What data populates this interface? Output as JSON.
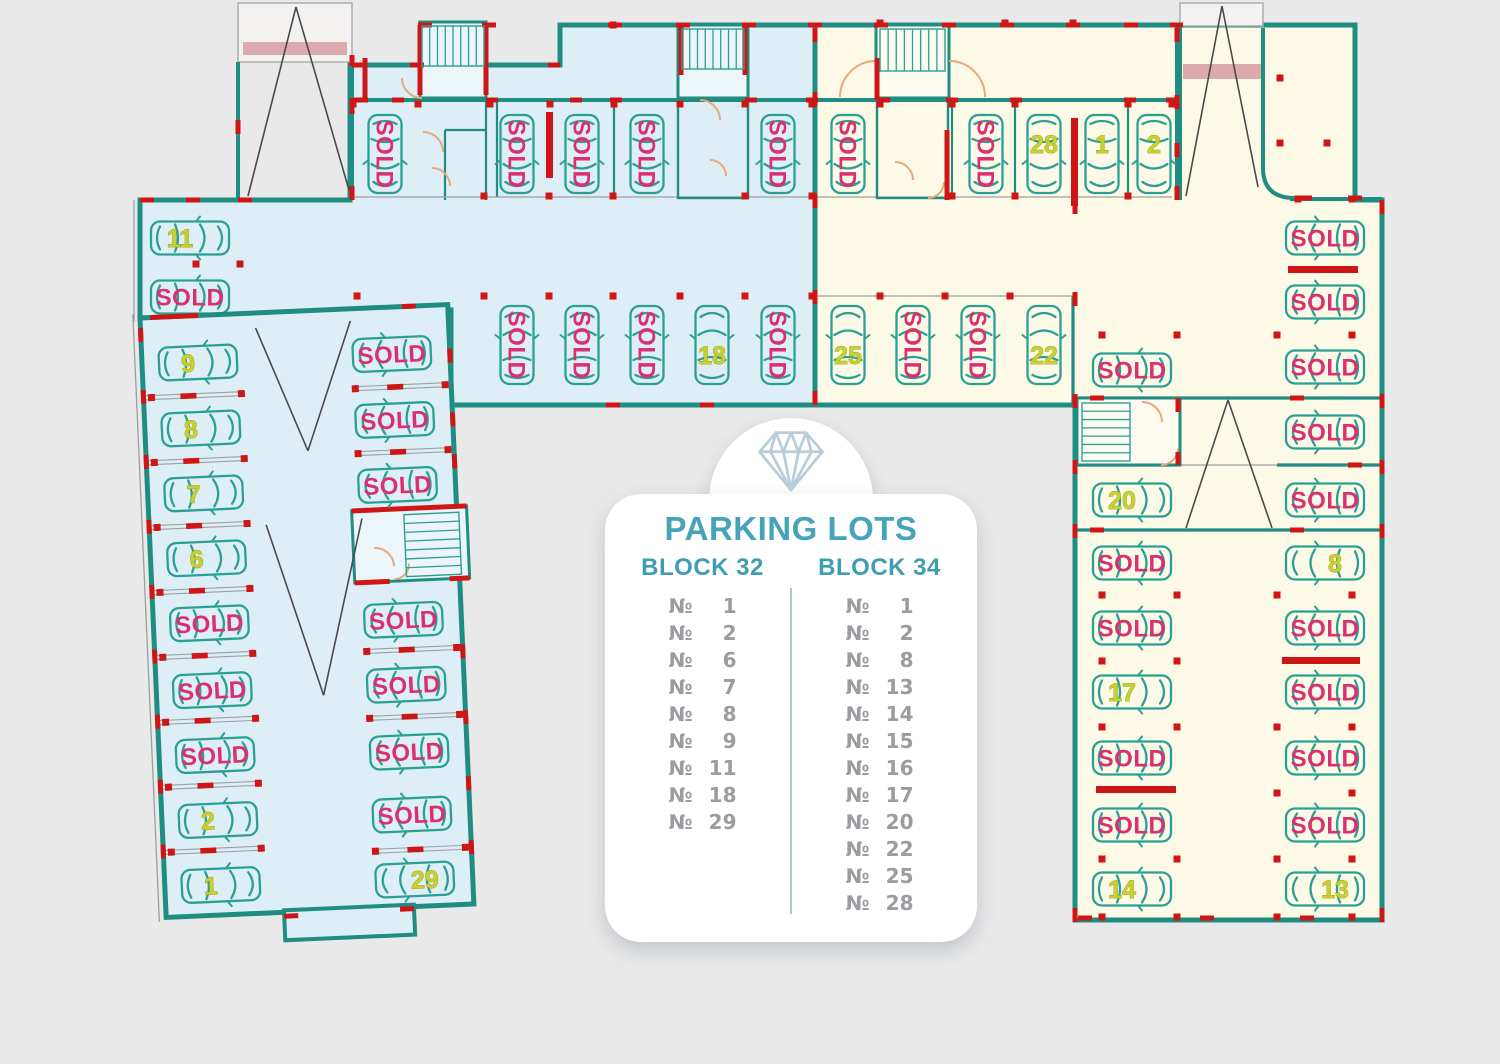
{
  "panel": {
    "title": "PARKING LOTS",
    "numero_symbol": "№",
    "blocks": [
      {
        "label": "BLOCK 32",
        "lots": [
          "1",
          "2",
          "6",
          "7",
          "8",
          "9",
          "11",
          "18",
          "29"
        ]
      },
      {
        "label": "BLOCK 34",
        "lots": [
          "1",
          "2",
          "8",
          "13",
          "14",
          "15",
          "16",
          "17",
          "20",
          "22",
          "25",
          "28"
        ]
      }
    ]
  },
  "sold_label": "SOLD",
  "colors": {
    "background": "#e9e9ea",
    "block32_fill": "#deeef6",
    "block34_fill": "#fcf9e6",
    "room_fill_blue": "#ecf5f8",
    "room_fill_yellow": "#fdfbef",
    "wall": "#1f8d82",
    "car_outline": "#2aa095",
    "sold_text": "#d93070",
    "number_text": "#c7d02f",
    "number_outline": "#939d1d",
    "accent_red": "#cf1616",
    "ramp_band": "#dcaaac",
    "ramp_line": "#4a4a4a",
    "door_arc": "#e8a87c",
    "thin_line": "#9aa0a0",
    "panel_title": "#47a3ba",
    "panel_block": "#3f9db3",
    "panel_text": "#9b9ba0",
    "panel_divider": "#a6c8d6",
    "diamond_icon": "#b8cdd9"
  },
  "cars_main": [
    {
      "x": 385,
      "y": 154,
      "a": 90,
      "s": 1
    },
    {
      "x": 517,
      "y": 154,
      "a": 90,
      "s": 1
    },
    {
      "x": 582,
      "y": 154,
      "a": 90,
      "s": 1
    },
    {
      "x": 647,
      "y": 154,
      "a": 90,
      "s": 1
    },
    {
      "x": 778,
      "y": 154,
      "a": 90,
      "s": 1
    },
    {
      "x": 848,
      "y": 154,
      "a": 90,
      "s": 1
    },
    {
      "x": 986,
      "y": 154,
      "a": 90,
      "s": 1
    },
    {
      "x": 1044,
      "y": 154,
      "a": 90,
      "l": "28"
    },
    {
      "x": 1102,
      "y": 154,
      "a": 90,
      "l": "1"
    },
    {
      "x": 1154,
      "y": 154,
      "a": 90,
      "l": "2"
    },
    {
      "x": 517,
      "y": 345,
      "a": -90,
      "s": 1
    },
    {
      "x": 582,
      "y": 345,
      "a": -90,
      "s": 1
    },
    {
      "x": 647,
      "y": 345,
      "a": -90,
      "s": 1
    },
    {
      "x": 712,
      "y": 345,
      "a": -90,
      "l": "18"
    },
    {
      "x": 778,
      "y": 345,
      "a": -90,
      "s": 1
    },
    {
      "x": 848,
      "y": 345,
      "a": -90,
      "l": "25"
    },
    {
      "x": 913,
      "y": 345,
      "a": -90,
      "s": 1
    },
    {
      "x": 978,
      "y": 345,
      "a": -90,
      "s": 1
    },
    {
      "x": 1044,
      "y": 345,
      "a": -90,
      "l": "22"
    },
    {
      "x": 190,
      "y": 238,
      "a": 0,
      "l": "11"
    },
    {
      "x": 190,
      "y": 297,
      "a": 0,
      "s": 1
    },
    {
      "x": 1132,
      "y": 370,
      "a": 0,
      "s": 1
    },
    {
      "x": 1132,
      "y": 500,
      "a": 0,
      "l": "20"
    },
    {
      "x": 1132,
      "y": 563,
      "a": 0,
      "s": 1
    },
    {
      "x": 1132,
      "y": 628,
      "a": 0,
      "s": 1
    },
    {
      "x": 1132,
      "y": 692,
      "a": 0,
      "l": "17"
    },
    {
      "x": 1132,
      "y": 758,
      "a": 0,
      "s": 1
    },
    {
      "x": 1132,
      "y": 825,
      "a": 0,
      "s": 1
    },
    {
      "x": 1132,
      "y": 889,
      "a": 0,
      "l": "14"
    },
    {
      "x": 1325,
      "y": 238,
      "a": 180,
      "s": 1
    },
    {
      "x": 1325,
      "y": 302,
      "a": 180,
      "s": 1
    },
    {
      "x": 1325,
      "y": 367,
      "a": 180,
      "s": 1
    },
    {
      "x": 1325,
      "y": 432,
      "a": 180,
      "s": 1
    },
    {
      "x": 1325,
      "y": 500,
      "a": 180,
      "s": 1
    },
    {
      "x": 1325,
      "y": 563,
      "a": 180,
      "l": "8"
    },
    {
      "x": 1325,
      "y": 628,
      "a": 180,
      "s": 1
    },
    {
      "x": 1325,
      "y": 692,
      "a": 180,
      "s": 1
    },
    {
      "x": 1325,
      "y": 758,
      "a": 180,
      "s": 1
    },
    {
      "x": 1325,
      "y": 825,
      "a": 180,
      "s": 1
    },
    {
      "x": 1325,
      "y": 889,
      "a": 180,
      "l": "13"
    }
  ],
  "cars_tilt": [
    {
      "x": 56,
      "y": 47,
      "a": 0,
      "l": "9"
    },
    {
      "x": 56,
      "y": 113,
      "a": 0,
      "l": "8"
    },
    {
      "x": 56,
      "y": 178,
      "a": 0,
      "l": "7"
    },
    {
      "x": 56,
      "y": 243,
      "a": 0,
      "l": "6"
    },
    {
      "x": 56,
      "y": 308,
      "a": 0,
      "s": 1
    },
    {
      "x": 56,
      "y": 375,
      "a": 0,
      "s": 1
    },
    {
      "x": 56,
      "y": 440,
      "a": 0,
      "s": 1
    },
    {
      "x": 56,
      "y": 505,
      "a": 0,
      "l": "2"
    },
    {
      "x": 56,
      "y": 570,
      "a": 0,
      "l": "1"
    },
    {
      "x": 250,
      "y": 47,
      "a": 180,
      "s": 1
    },
    {
      "x": 250,
      "y": 113,
      "a": 180,
      "s": 1
    },
    {
      "x": 250,
      "y": 178,
      "a": 180,
      "s": 1
    },
    {
      "x": 250,
      "y": 313,
      "a": 180,
      "s": 1
    },
    {
      "x": 250,
      "y": 378,
      "a": 180,
      "s": 1
    },
    {
      "x": 250,
      "y": 445,
      "a": 180,
      "s": 1
    },
    {
      "x": 250,
      "y": 508,
      "a": 180,
      "s": 1
    },
    {
      "x": 250,
      "y": 573,
      "a": 180,
      "l": "29"
    }
  ],
  "ticks_main": [
    [
      353,
      104
    ],
    [
      418,
      104
    ],
    [
      490,
      104
    ],
    [
      550,
      104
    ],
    [
      614,
      104
    ],
    [
      680,
      104
    ],
    [
      745,
      104
    ],
    [
      812,
      104
    ],
    [
      880,
      104
    ],
    [
      952,
      104
    ],
    [
      1015,
      104
    ],
    [
      1128,
      104
    ],
    [
      1172,
      104
    ],
    [
      484,
      196
    ],
    [
      549,
      196
    ],
    [
      613,
      196
    ],
    [
      745,
      196
    ],
    [
      812,
      196
    ],
    [
      952,
      196
    ],
    [
      1015,
      196
    ],
    [
      1128,
      196
    ],
    [
      357,
      296
    ],
    [
      484,
      296
    ],
    [
      549,
      296
    ],
    [
      613,
      296
    ],
    [
      680,
      296
    ],
    [
      745,
      296
    ],
    [
      812,
      296
    ],
    [
      880,
      296
    ],
    [
      945,
      296
    ],
    [
      1010,
      296
    ],
    [
      196,
      264
    ],
    [
      240,
      264
    ],
    [
      613,
      25
    ],
    [
      880,
      23
    ],
    [
      1005,
      23
    ],
    [
      1073,
      23
    ],
    [
      1102,
      335
    ],
    [
      1177,
      335
    ],
    [
      1277,
      335
    ],
    [
      1352,
      335
    ],
    [
      1280,
      78
    ],
    [
      1280,
      143
    ],
    [
      1327,
      143
    ],
    [
      1102,
      595
    ],
    [
      1177,
      595
    ],
    [
      1277,
      595
    ],
    [
      1352,
      595
    ],
    [
      1102,
      661
    ],
    [
      1177,
      661
    ],
    [
      1102,
      727
    ],
    [
      1177,
      727
    ],
    [
      1277,
      727
    ],
    [
      1352,
      727
    ],
    [
      1277,
      793
    ],
    [
      1352,
      793
    ],
    [
      1102,
      859
    ],
    [
      1177,
      859
    ],
    [
      1277,
      859
    ],
    [
      1352,
      859
    ],
    [
      1102,
      917
    ],
    [
      1177,
      917
    ],
    [
      1277,
      917
    ],
    [
      1352,
      917
    ],
    [
      1298,
      199
    ],
    [
      1352,
      199
    ]
  ],
  "ticks_tilt": [
    [
      8,
      80
    ],
    [
      98,
      80
    ],
    [
      8,
      145
    ],
    [
      98,
      145
    ],
    [
      8,
      210
    ],
    [
      98,
      210
    ],
    [
      8,
      275
    ],
    [
      98,
      275
    ],
    [
      8,
      340
    ],
    [
      98,
      340
    ],
    [
      8,
      405
    ],
    [
      98,
      405
    ],
    [
      8,
      470
    ],
    [
      98,
      470
    ],
    [
      8,
      535
    ],
    [
      98,
      535
    ],
    [
      212,
      80
    ],
    [
      302,
      80
    ],
    [
      212,
      145
    ],
    [
      302,
      145
    ],
    [
      212,
      343
    ],
    [
      302,
      343
    ],
    [
      212,
      410
    ],
    [
      302,
      410
    ],
    [
      212,
      543
    ],
    [
      302,
      543
    ]
  ],
  "dividers_tilt": {
    "left": {
      "x1": 2,
      "x2": 98,
      "redx": 45,
      "ys": [
        80,
        145,
        210,
        275,
        340,
        405,
        470,
        535
      ]
    },
    "right": {
      "x1": 210,
      "x2": 306,
      "redx": 252,
      "ys": [
        80,
        145,
        343,
        410,
        543
      ]
    }
  }
}
